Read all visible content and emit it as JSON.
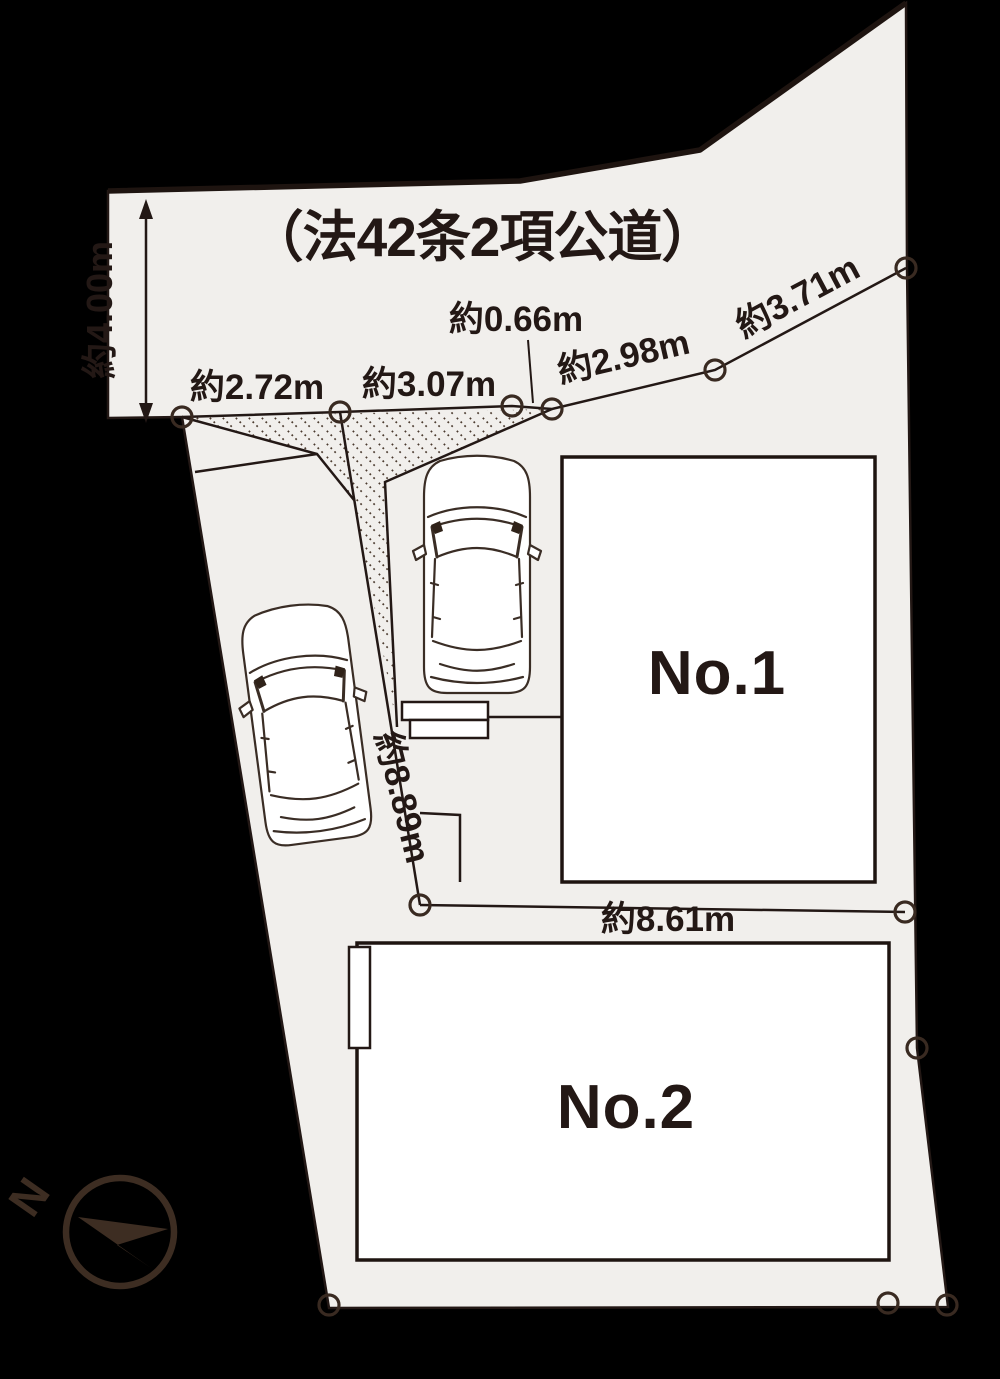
{
  "diagram": {
    "type": "site-plan",
    "road_label": "（法42条2項公道）",
    "north_label": "N"
  },
  "buildings": {
    "no1_label": "No.1",
    "no2_label": "No.2"
  },
  "dimensions": {
    "road_width": "約4.00m",
    "frontage_1": "約2.72m",
    "frontage_2": "約3.07m",
    "frontage_3": "約0.66m",
    "frontage_4": "約2.98m",
    "frontage_5": "約3.71m",
    "west_boundary": "約8.89m",
    "middle_boundary": "約8.61m"
  },
  "colors": {
    "background": "#000000",
    "land_fill": "#f1efec",
    "ink": "#231815",
    "marker_ring": "#392a21",
    "building_fill": "#ffffff",
    "compass": "#3d2d22"
  }
}
